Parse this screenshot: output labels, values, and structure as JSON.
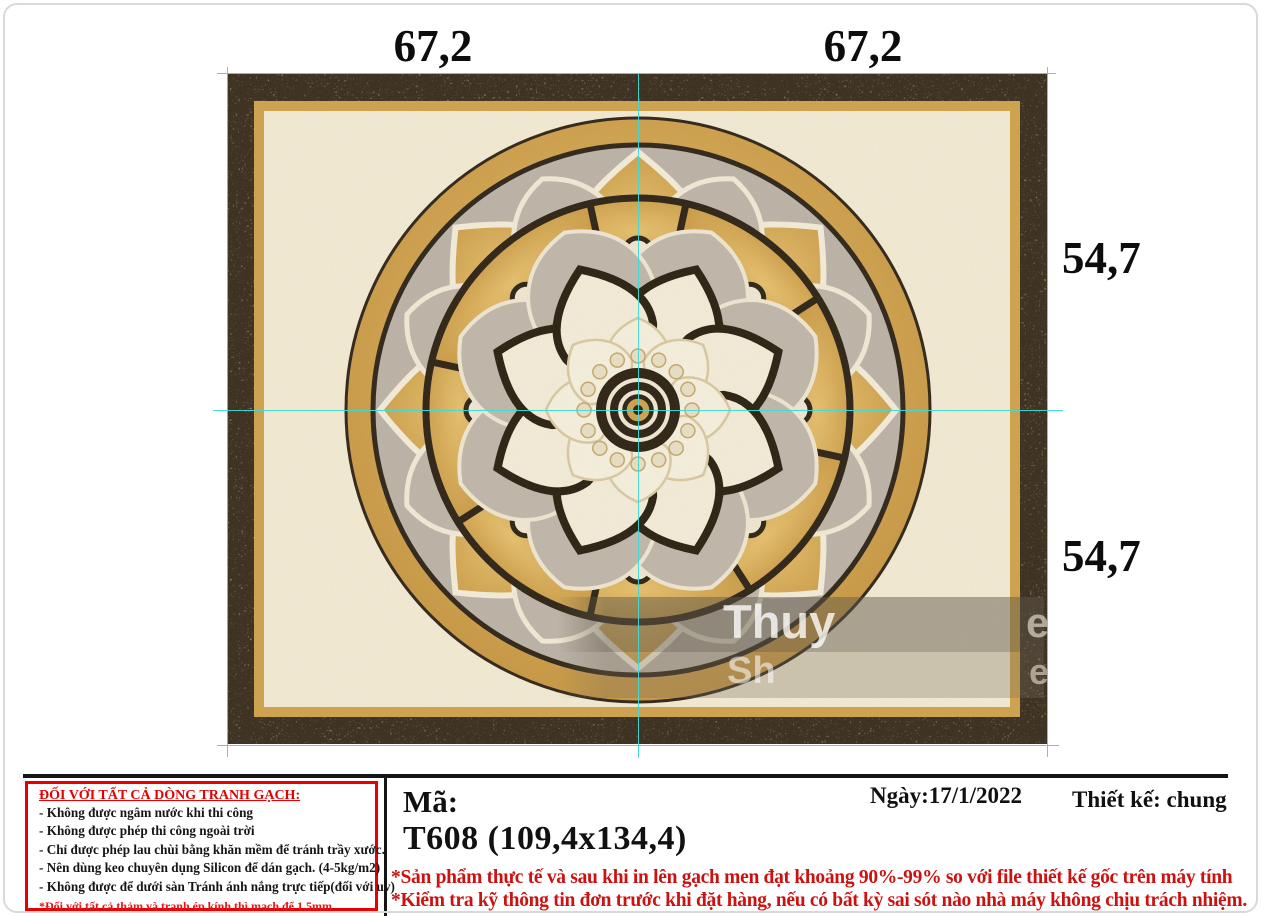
{
  "measurements": {
    "top_left": "67,2",
    "top_right": "67,2",
    "right_upper": "54,7",
    "right_lower": "54,7"
  },
  "notice_box": {
    "title": "ĐỐI VỚI TẤT CẢ DÒNG TRANH GẠCH:",
    "rules": [
      "- Không được ngâm nước khi thi công",
      "- Không được phép thi công ngoài trời",
      "- Chỉ được phép lau chùi bằng khăn mềm để tránh trầy xước.",
      "- Nên dùng keo chuyên dụng Silicon để dán gạch. (4-5kg/m2)",
      "- Không được để dưới sàn Tránh ánh nắng trực tiếp(đối với uv)"
    ],
    "notes": [
      "*Đối với tất cả thảm và tranh ép kính thì mạch để 1,5mm",
      "nên lát bằng vữa tổng hợp và chít gạch bằng keo silicon"
    ]
  },
  "product": {
    "code_label": "Mã:",
    "code": "T608 (109,4x134,4)"
  },
  "meta": {
    "date": "Ngày:17/1/2022",
    "designer": "Thiết kế: chung"
  },
  "disclaimers": [
    "*Sản phẩm thực tế và sau khi in lên gạch men đạt khoảng 90%-99% so với file thiết kế gốc trên máy tính",
    "*Kiểm tra kỹ thông tin đơn trước khi đặt hàng, nếu có bất kỳ sai sót nào nhà máy không chịu trách nhiệm."
  ],
  "watermark": {
    "line1": "Thuy",
    "line2": "Sh",
    "right1": "e",
    "right2": "e"
  },
  "colors": {
    "guide_cyan": "#3fd9d4",
    "notice_red": "#e60000",
    "disclaimer_red": "#cc1111",
    "granite_border": "#3a2e1f",
    "gold": "#cfa24d",
    "cream_field": "#f2ead3",
    "grey_marble": "#bcb3a8",
    "dark_outline": "#2e2416"
  }
}
